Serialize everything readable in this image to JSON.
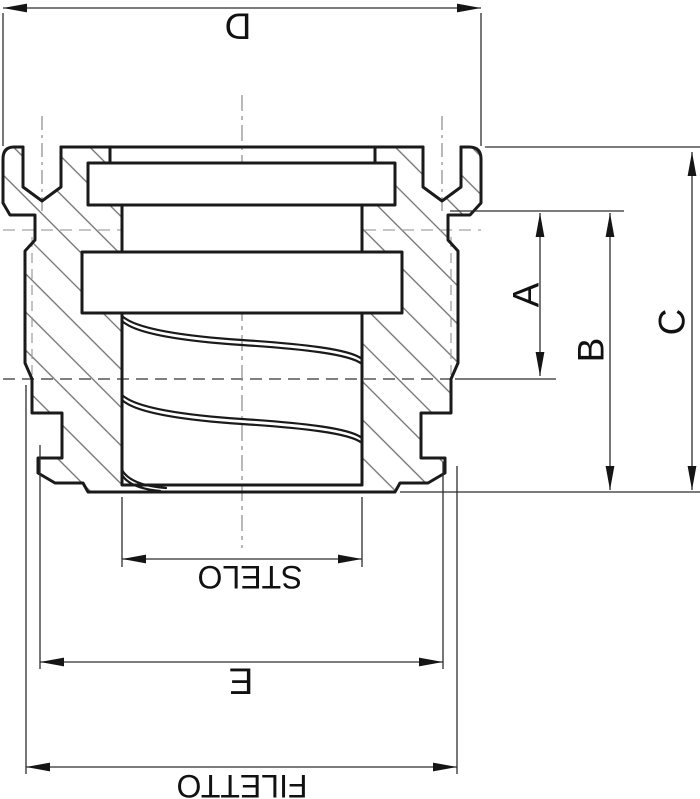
{
  "drawing": {
    "labels": {
      "top_width": "D",
      "depth_a": "A",
      "depth_b": "B",
      "depth_c": "C",
      "bore": "STELO",
      "pilot": "E",
      "thread": "FILETTO"
    },
    "colors": {
      "background": "#ffffff",
      "outline": "#1a1a1a",
      "dimension": "#2e2e2e",
      "hatch": "#6e6e6e",
      "centerline": "#8a8a8a"
    }
  }
}
